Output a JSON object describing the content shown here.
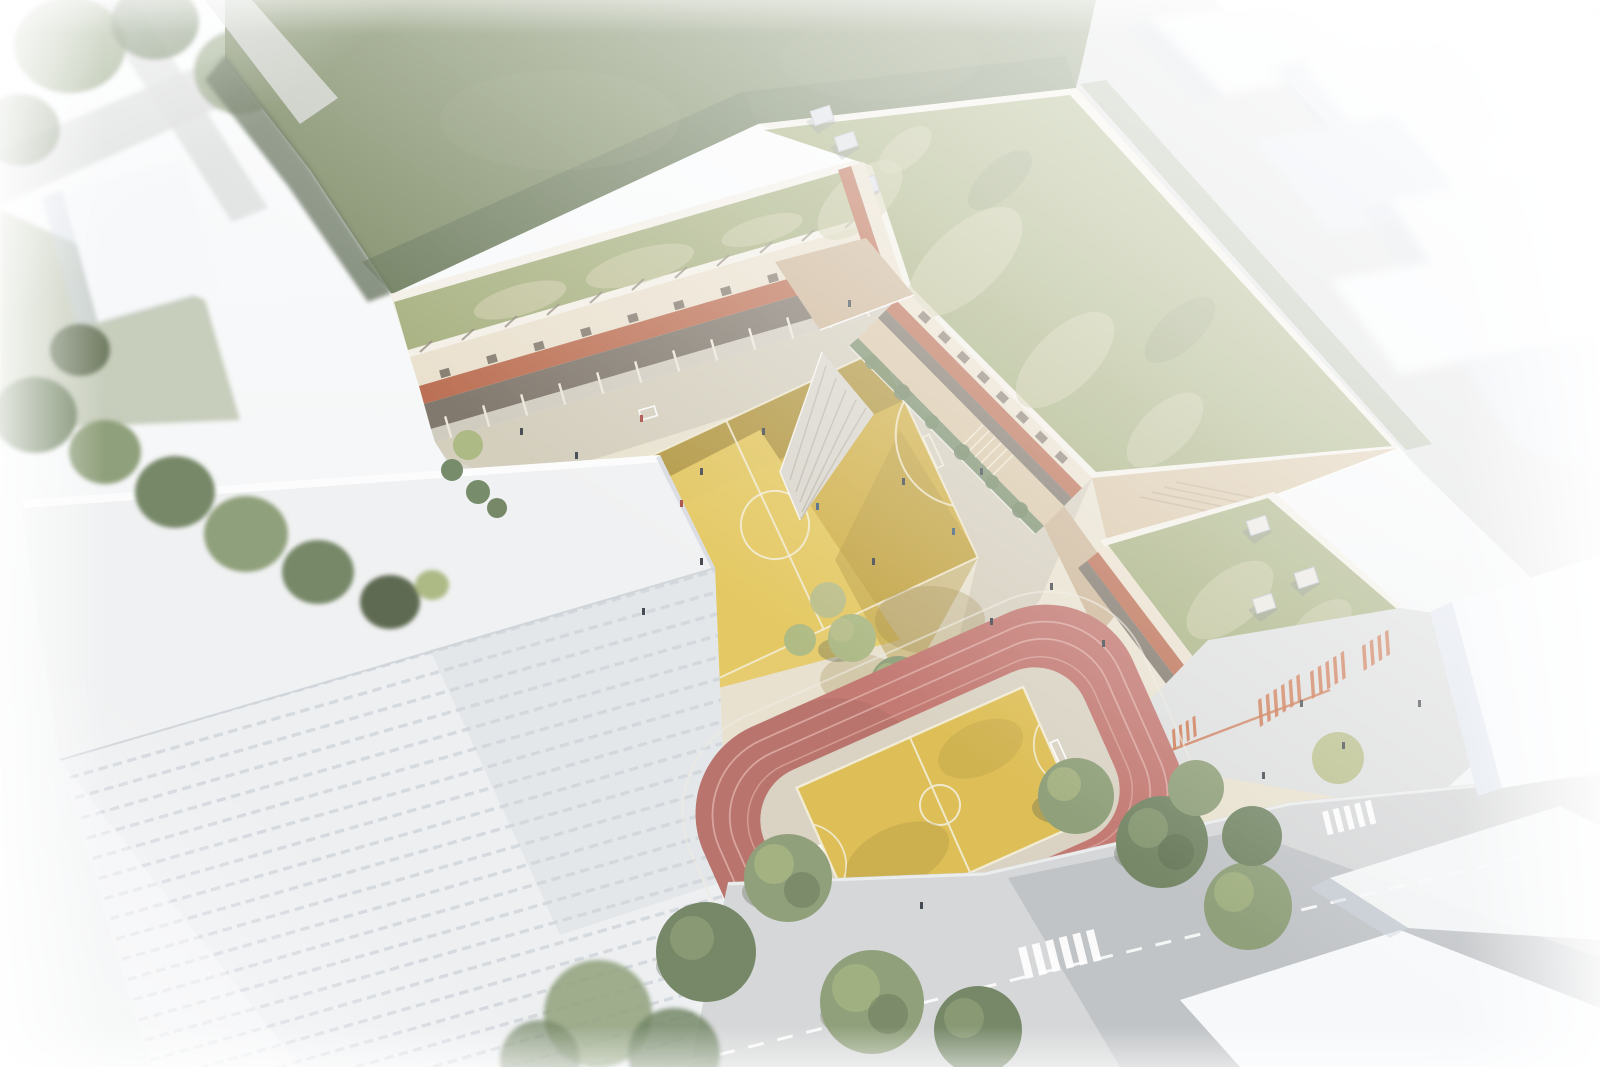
{
  "scene": {
    "type": "architectural-aerial-render",
    "description": "Aerial rendering of a U-shaped school building with extensive green sedum roofs enclosing a schoolyard with a yellow painted ball court, wooden terraces and ramps, a red running track ring with a yellow basketball court among trees, a large white slab building in front, and surrounding streets, zebra crossings and faded white context buildings.",
    "objects": [
      "dark green sports lawn",
      "green sedum roofs with skylight boxes",
      "U-shaped school building with brick and cream facade",
      "schoolyard with yellow ball-game court and white markings",
      "wooden roof terrace, walkway and stair ramp",
      "red running track ring with yellow basketball court",
      "large white slab building with slotted facade",
      "streets with dashed lane lines and zebra crossings",
      "entrance plaza with orange ground graphics",
      "trees, hedges and planting strips",
      "white abstract context buildings fading to the edges",
      "tiny human figures in the yard and on terraces"
    ]
  },
  "colors": {
    "bg_top": "#fbfcfd",
    "bg_bottom": "#eef0f1",
    "field_green": "#7c8a64",
    "field_light": "#93a07a",
    "hedge_dark": "#52614a",
    "field_shadow": "#5e6c50",
    "roof_green": "#a3ad7a",
    "roof_patch": "#cbc9a4",
    "parapet": "#f3efe6",
    "cream": "#e9dfcc",
    "cream_shade": "#d8cbb2",
    "brick": "#b96a4d",
    "brick_dark": "#9a5440",
    "glazing": "#7b7266",
    "column": "#ece6da",
    "wood": "#cbb394",
    "wood_light": "#d8c5a6",
    "wood_shade": "#b59c7e",
    "concrete_ramp": "#d8d4cb",
    "yard": "#e7e0cd",
    "yard_shade": "#c5beae",
    "yard_light": "#efe8d6",
    "court_sun": "#e5c85e",
    "court_mid": "#cfae45",
    "court_shade": "#b3963c",
    "court_dark": "#8f7832",
    "court_line": "#f2ecd6",
    "track_red": "#c0736c",
    "track_shade": "#a2625c",
    "track_line": "#daa69e",
    "track_infield": "#d8d1c1",
    "track_court": "#dcbb4e",
    "street": "#dcdddd",
    "road": "#d4d5d6",
    "street_dark": "#a8adb2",
    "marking": "#ffffff",
    "slab_roof": "#f0f1f2",
    "slab_face": "#edeff1",
    "slab_slit": "#d2d7dd",
    "slab_shadow": "#ccd2d8",
    "ctx_white": "#f6f8fa",
    "ctx_face": "#e1e6ee",
    "ctx_shadow": "#ccd4e0",
    "tree_a": "#8a9b74",
    "tree_b": "#6f8260",
    "tree_c": "#a9b780",
    "tree_d": "#566449",
    "tree_e": "#b6bc86",
    "bush": "#6f8662",
    "shadow_veg": "#55624a",
    "people_dark": "#3b4249",
    "people_red": "#a4453c",
    "people_blue": "#3d5a78",
    "orange_mark": "#c96a3f",
    "skybox": "#d9dde2",
    "skybox_edge": "#b9bfc7",
    "skybox_white": "#e8e6df",
    "window_dark": "#6f655a",
    "white": "#ffffff"
  }
}
